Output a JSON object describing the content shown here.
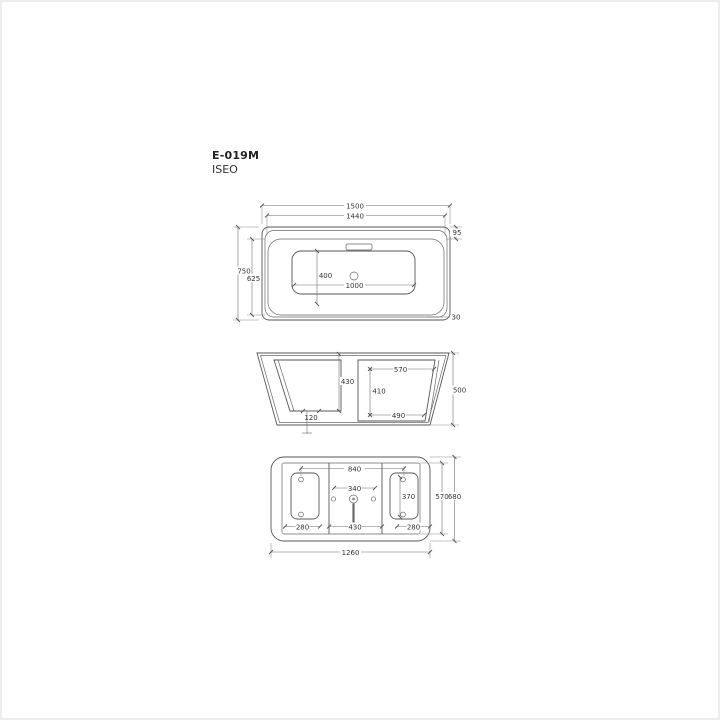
{
  "product": {
    "model": "E-019M",
    "name": "ISEO"
  },
  "line_color": "#565656",
  "views": {
    "top": {
      "dims": {
        "outer_length": "1500",
        "inner_length": "1440",
        "rim_inset": "95",
        "outer_width": "750",
        "inner_width": "625",
        "basin_length": "1000",
        "basin_width": "400",
        "edge_radius": "30"
      }
    },
    "side": {
      "dims": {
        "left_inner_height": "430",
        "drain_offset": "120",
        "right_top_width": "570",
        "right_inner_height": "410",
        "right_bottom_width": "490",
        "overall_height": "500"
      }
    },
    "bottom": {
      "dims": {
        "hole_span": "840",
        "faucet_span": "340",
        "pad_height": "370",
        "left_pad_width": "280",
        "center_width": "430",
        "right_pad_width": "280",
        "inner_width": "570",
        "outer_width": "680",
        "base_length": "1260"
      }
    }
  }
}
